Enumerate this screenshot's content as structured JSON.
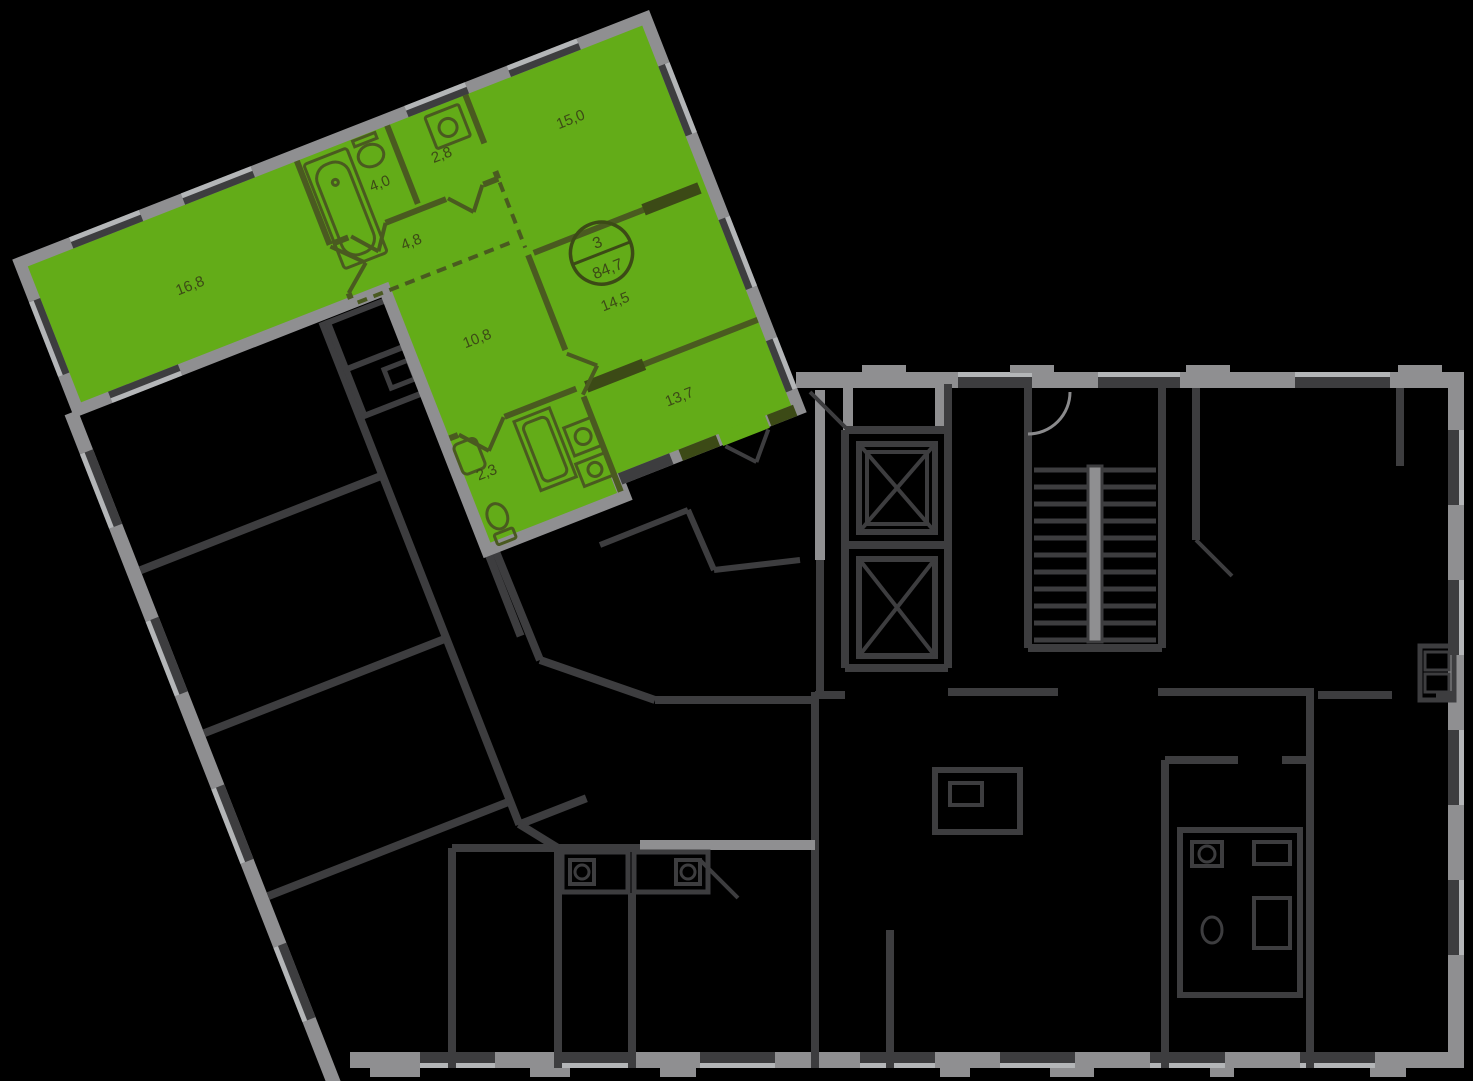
{
  "palette": {
    "bg": "#000000",
    "green": "#63ac18",
    "green_line": "#4a5a20",
    "label": "#3c4a16",
    "wall_gray": "#8f8f91",
    "wall_dark": "#3d3d3f",
    "wall_light": "#b4b6b8"
  },
  "apartment": {
    "badge": {
      "rooms_count": "3",
      "total_area": "84,7"
    },
    "rooms": [
      {
        "name": "living-room",
        "area": "16,8",
        "x": 150,
        "y": 88
      },
      {
        "name": "bathroom",
        "area": "4,0",
        "x": 364,
        "y": 62
      },
      {
        "name": "toilet",
        "area": "2,8",
        "x": 432,
        "y": 58
      },
      {
        "name": "bedroom-1",
        "area": "15,0",
        "x": 565,
        "y": 72
      },
      {
        "name": "hallway",
        "area": "4,8",
        "x": 372,
        "y": 128
      },
      {
        "name": "bedroom-2",
        "area": "14,5",
        "x": 540,
        "y": 258
      },
      {
        "name": "bedroom-3",
        "area": "10,8",
        "x": 398,
        "y": 242
      },
      {
        "name": "kitchen",
        "area": "13,7",
        "x": 565,
        "y": 370
      },
      {
        "name": "bathroom-2",
        "area": "2,3",
        "x": 358,
        "y": 370
      }
    ]
  }
}
